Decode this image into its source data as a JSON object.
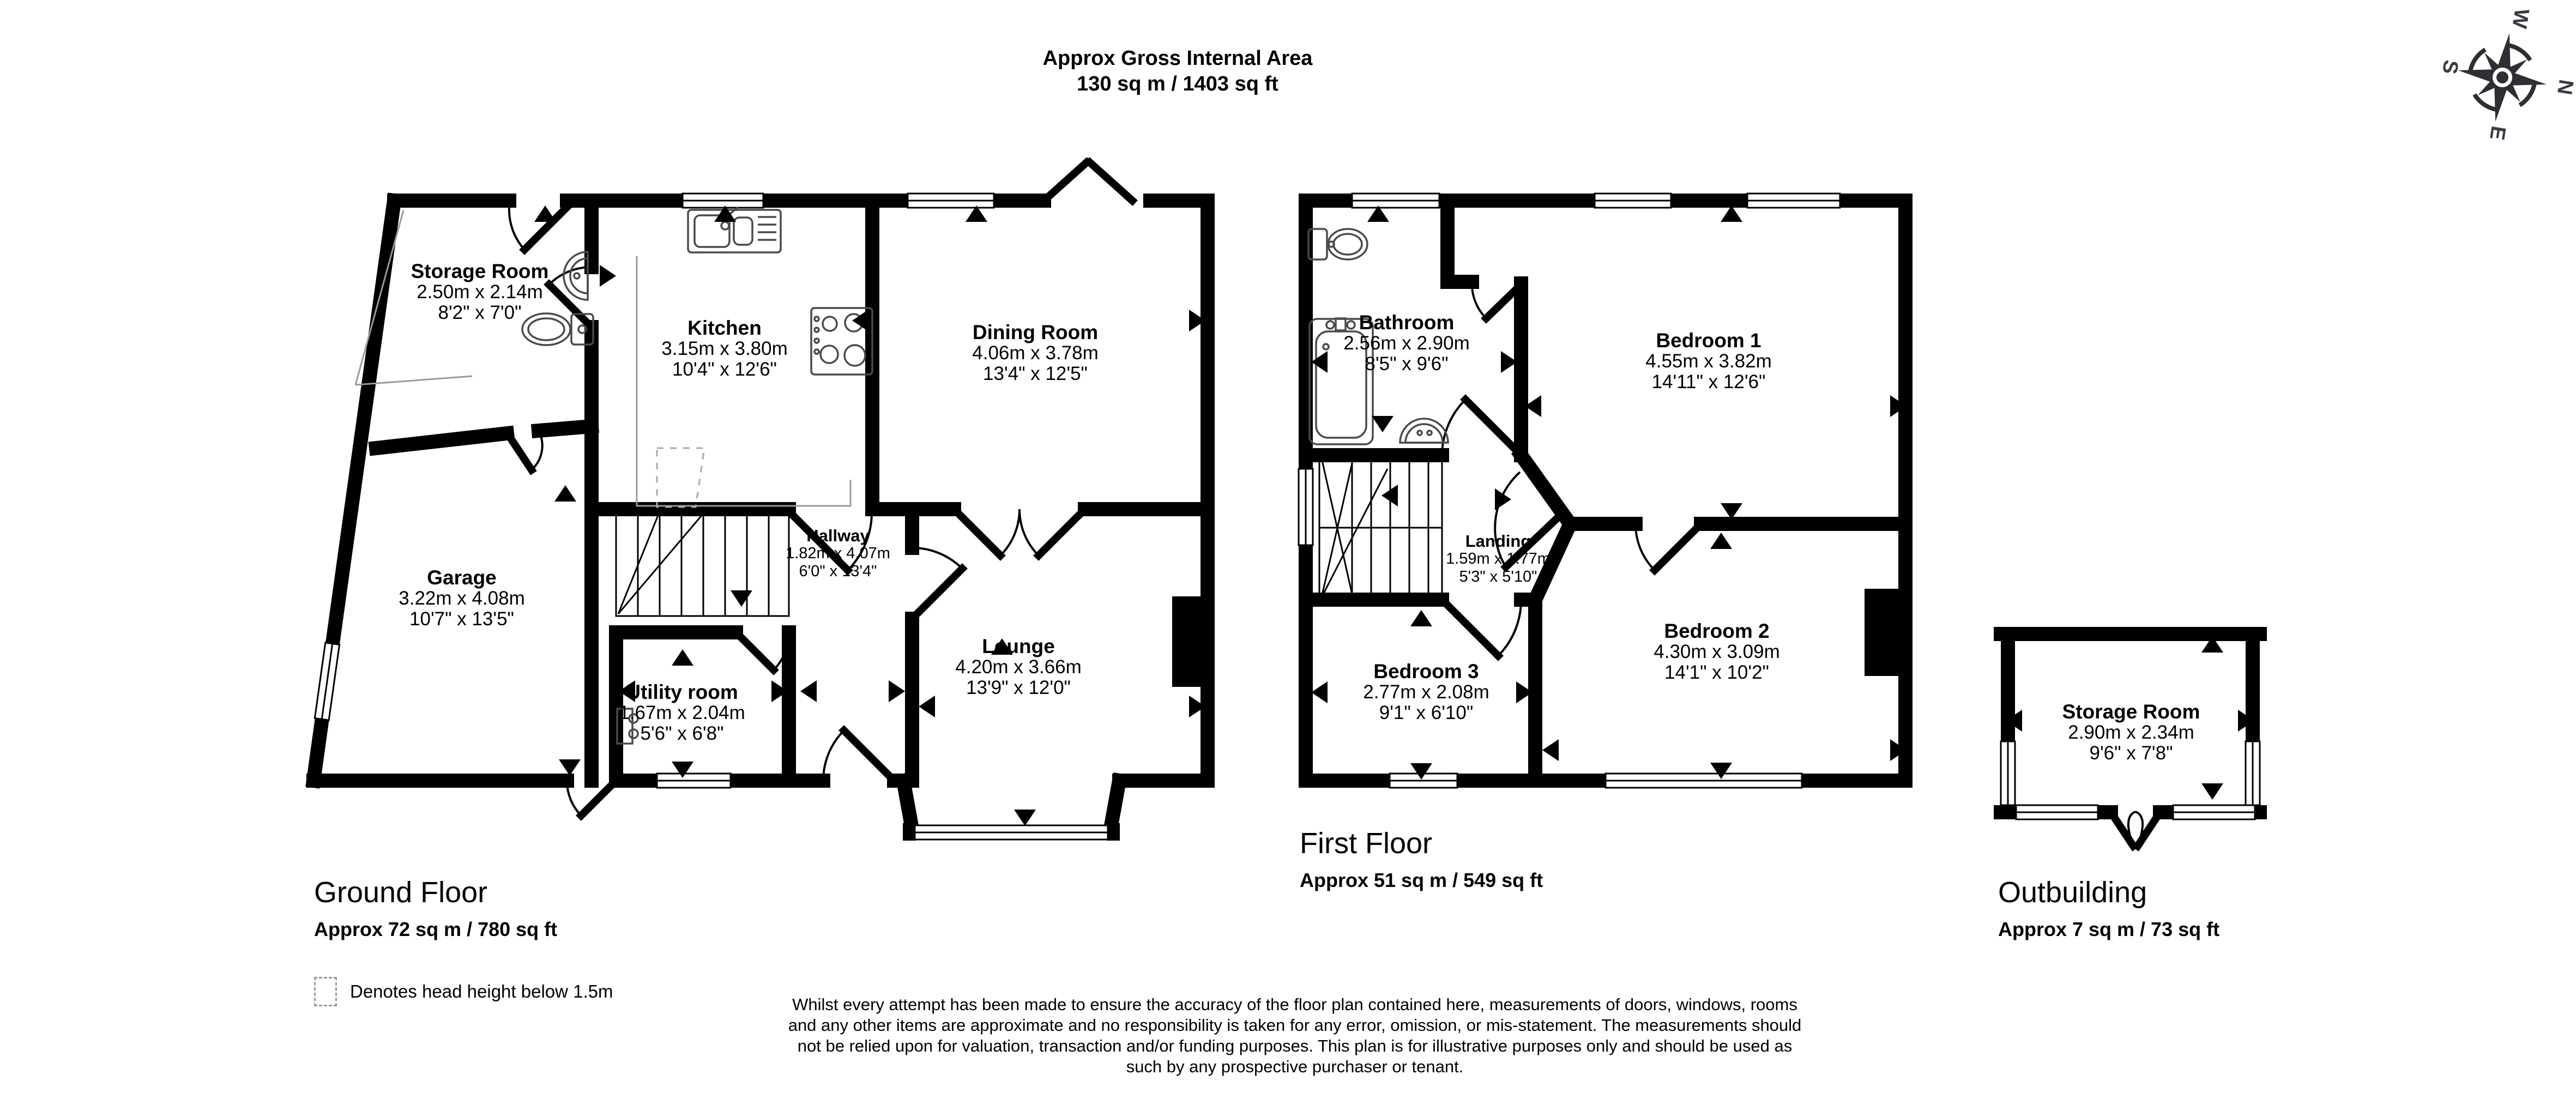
{
  "title": {
    "line1": "Approx Gross Internal Area",
    "line2": "130 sq m / 1403 sq ft"
  },
  "compass": {
    "n": "N",
    "e": "E",
    "s": "S",
    "w": "W"
  },
  "floors": {
    "ground": {
      "name": "Ground Floor",
      "area": "Approx 72 sq m / 780 sq ft"
    },
    "first": {
      "name": "First Floor",
      "area": "Approx 51 sq m / 549 sq ft"
    },
    "outbuilding": {
      "name": "Outbuilding",
      "area": "Approx 7 sq m / 73 sq ft"
    }
  },
  "rooms": {
    "storage_gf": {
      "name": "Storage Room",
      "metric": "2.50m x 2.14m",
      "imperial": "8'2\" x 7'0\""
    },
    "kitchen": {
      "name": "Kitchen",
      "metric": "3.15m x 3.80m",
      "imperial": "10'4\" x 12'6\""
    },
    "dining": {
      "name": "Dining Room",
      "metric": "4.06m x 3.78m",
      "imperial": "13'4\" x 12'5\""
    },
    "garage": {
      "name": "Garage",
      "metric": "3.22m x 4.08m",
      "imperial": "10'7\" x 13'5\""
    },
    "hallway": {
      "name": "Hallway",
      "metric": "1.82m x 4.07m",
      "imperial": "6'0\" x 13'4\""
    },
    "lounge": {
      "name": "Lounge",
      "metric": "4.20m x 3.66m",
      "imperial": "13'9\" x 12'0\""
    },
    "utility": {
      "name": "Utility room",
      "metric": "1.67m x 2.04m",
      "imperial": "5'6\" x 6'8\""
    },
    "bathroom": {
      "name": "Bathroom",
      "metric": "2.56m x 2.90m",
      "imperial": "8'5\" x 9'6\""
    },
    "bedroom1": {
      "name": "Bedroom 1",
      "metric": "4.55m x 3.82m",
      "imperial": "14'11\" x 12'6\""
    },
    "landing": {
      "name": "Landing",
      "metric": "1.59m x 1.77m",
      "imperial": "5'3\" x 5'10\""
    },
    "bedroom2": {
      "name": "Bedroom 2",
      "metric": "4.30m x 3.09m",
      "imperial": "14'1\" x 10'2\""
    },
    "bedroom3": {
      "name": "Bedroom 3",
      "metric": "2.77m x 2.08m",
      "imperial": "9'1\" x 6'10\""
    },
    "storage_ob": {
      "name": "Storage Room",
      "metric": "2.90m x 2.34m",
      "imperial": "9'6\" x 7'8\""
    }
  },
  "legend": {
    "text": "Denotes head height below 1.5m"
  },
  "disclaimer": "Whilst every attempt has been made to ensure the accuracy of the floor plan contained here, measurements of doors, windows, rooms and any other items are approximate and no responsibility is taken for any error, omission, or mis-statement. The measurements should not be relied upon for valuation, transaction and/or funding purposes. This plan is for illustrative purposes only and should be used as such by any prospective purchaser or tenant."
}
